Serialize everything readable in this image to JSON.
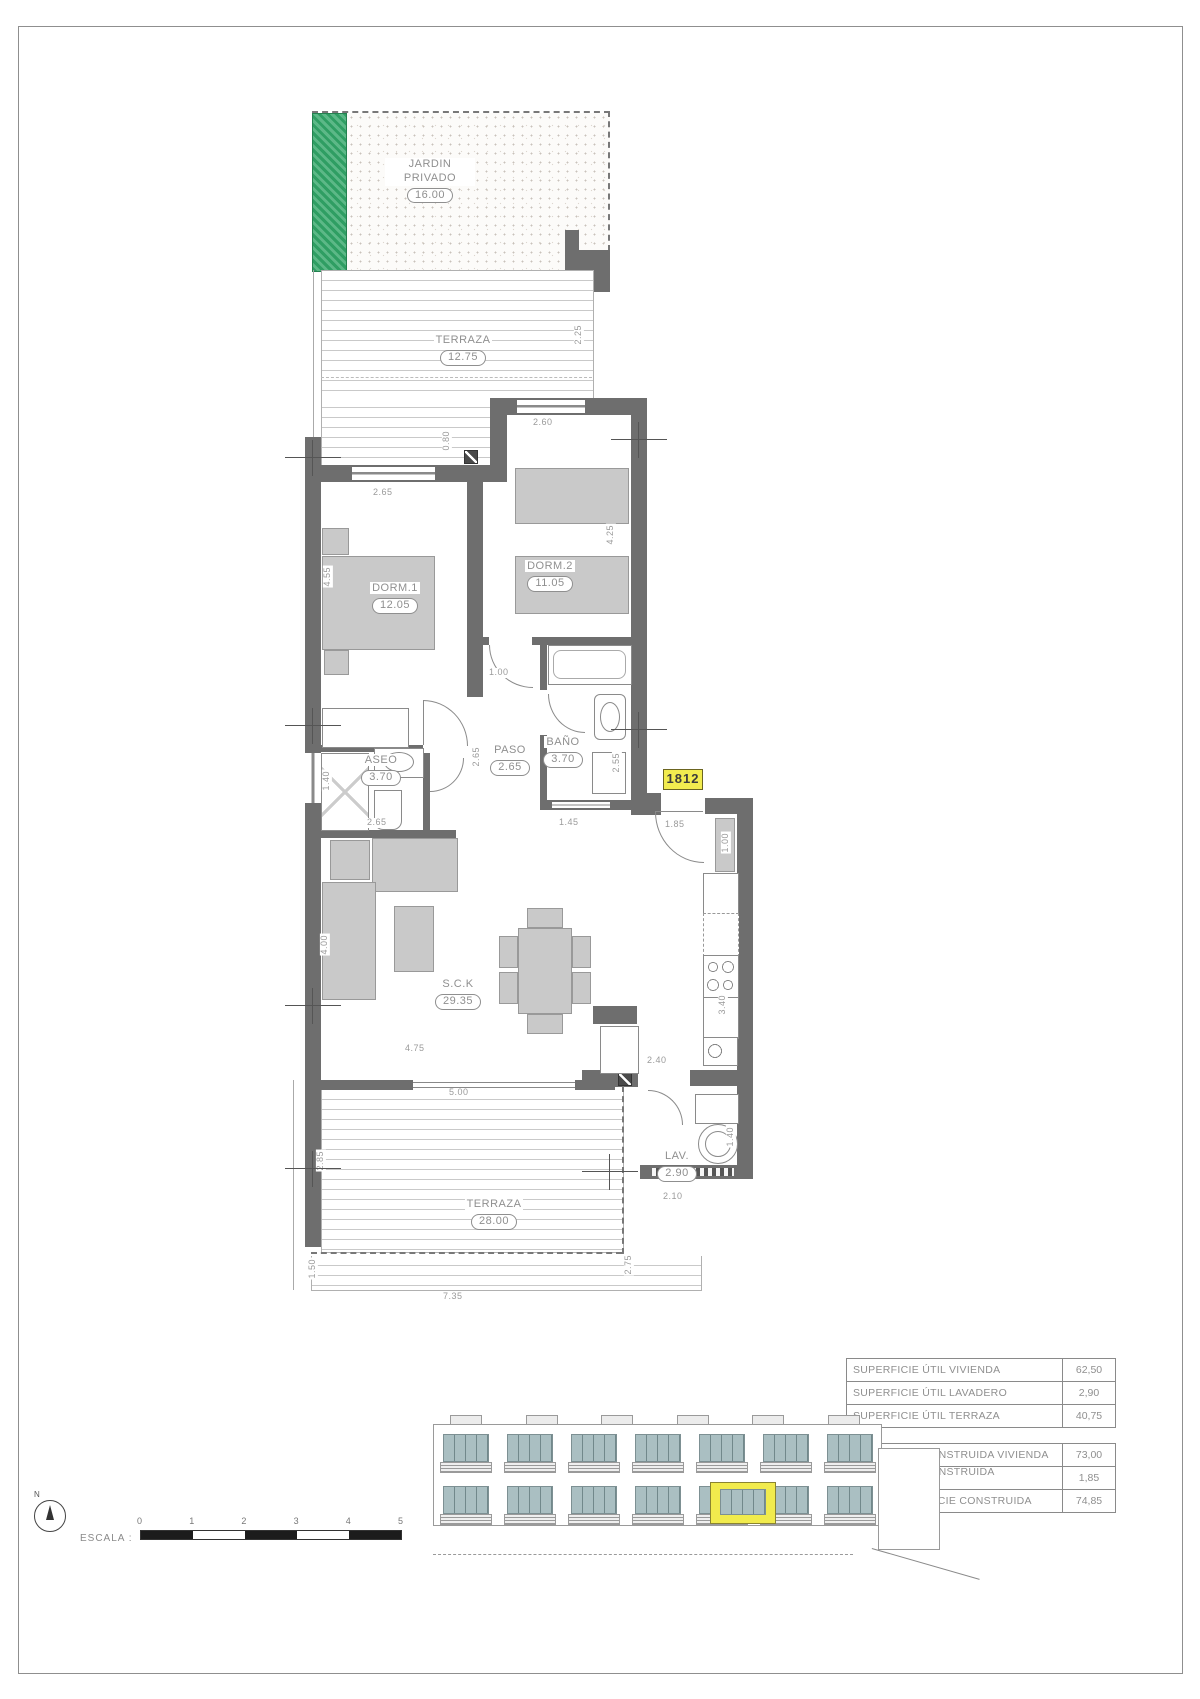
{
  "sheet": {
    "unit_number": "1812"
  },
  "rooms": {
    "jardin": {
      "name": "JARDIN PRIVADO",
      "area": "16.00"
    },
    "terraza_top": {
      "name": "TERRAZA",
      "area": "12.75"
    },
    "dorm1": {
      "name": "DORM.1",
      "area": "12.05"
    },
    "dorm2": {
      "name": "DORM.2",
      "area": "11.05"
    },
    "aseo": {
      "name": "ASEO",
      "area": "3.70"
    },
    "paso": {
      "name": "PASO",
      "area": "2.65"
    },
    "bano": {
      "name": "BAÑO",
      "area": "3.70"
    },
    "sck": {
      "name": "S.C.K",
      "area": "29.35"
    },
    "lav": {
      "name": "LAV.",
      "area": "2.90"
    },
    "terraza_bottom": {
      "name": "TERRAZA",
      "area": "28.00"
    }
  },
  "dims": {
    "terraza_top_right": "2.25",
    "deck_step": "0.80",
    "dorm1_window": "2.65",
    "dorm2_window": "2.60",
    "dorm1_depth": "4.55",
    "dorm2_depth": "4.25",
    "paso_width": "1.00",
    "paso_depth": "2.65",
    "aseo_left": "1.40",
    "aseo_width": "2.65",
    "bano_window": "1.45",
    "bano_right": "2.55",
    "entry_door": "1.85",
    "entry_closet": "1.00",
    "sck_left": "4.00",
    "kitchen_depth": "3.40",
    "sck_width": "4.75",
    "terraza_opening": "5.00",
    "kitchen_pass": "2.40",
    "terraza_step": "1.60",
    "lav_width": "2.10",
    "lav_right": "1.40",
    "terraza_left": "2.85",
    "terraza_ext_left": "1.50",
    "terraza_ext_right": "2.75",
    "terraza_width": "7.35"
  },
  "tables": {
    "util": {
      "rows": [
        {
          "label": "SUPERFICIE ÚTIL VIVIENDA",
          "value": "62,50"
        },
        {
          "label": "SUPERFICIE ÚTIL LAVADERO",
          "value": "2,90"
        },
        {
          "label": "SUPERFICIE ÚTIL TERRAZA",
          "value": "40,75"
        }
      ]
    },
    "construida": {
      "rows": [
        {
          "label": "SUPERFICIE CONSTRUIDA VIVIENDA",
          "value": "73,00"
        },
        {
          "label": "SUPERFICIE CONSTRUIDA EL.COMUNES",
          "value": "1,85"
        },
        {
          "label": "TOTAL SUPERFICIE CONSTRUIDA",
          "value": "74,85"
        }
      ]
    }
  },
  "scale_bar": {
    "label": "ESCALA :",
    "ticks": [
      "0",
      "1",
      "2",
      "3",
      "4",
      "5"
    ]
  },
  "north": {
    "label": "N"
  },
  "colors": {
    "accent_yellow": "#f2ec4f",
    "hedge_green": "#2f9e63",
    "wall_gray": "#6e6e6e"
  }
}
